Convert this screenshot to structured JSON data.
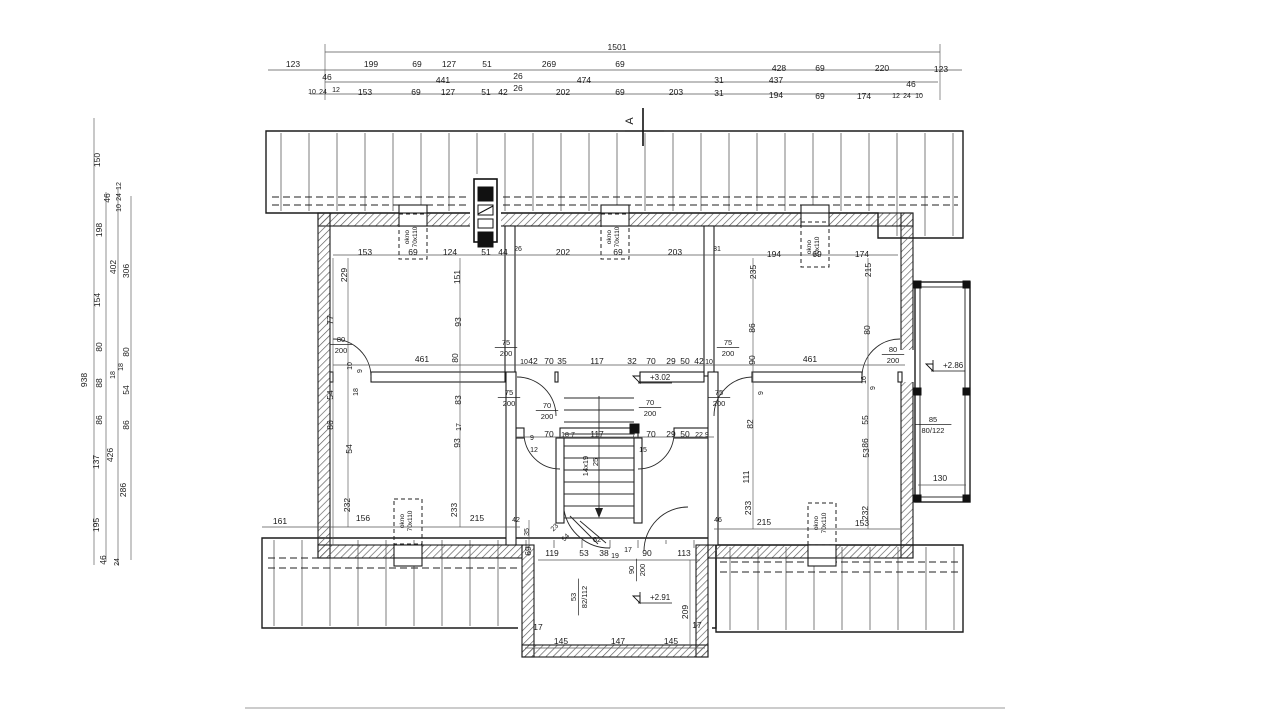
{
  "section_marker": {
    "label": "A"
  },
  "window_label": {
    "line1": "okno",
    "line2": "70x110"
  },
  "stair": {
    "steps": "14x19",
    "tread": "25"
  },
  "levels": [
    {
      "t": "+3.02",
      "x": 648,
      "y": 380
    },
    {
      "t": "+2.86",
      "x": 941,
      "y": 368
    },
    {
      "t": "+2.91",
      "x": 648,
      "y": 600
    }
  ],
  "fractions": [
    {
      "tp": "80",
      "bt": "200",
      "x": 341,
      "y": 344
    },
    {
      "tp": "75",
      "bt": "200",
      "x": 506,
      "y": 347
    },
    {
      "tp": "75",
      "bt": "200",
      "x": 728,
      "y": 347
    },
    {
      "tp": "80",
      "bt": "200",
      "x": 893,
      "y": 354
    },
    {
      "tp": "75",
      "bt": "200",
      "x": 509,
      "y": 397
    },
    {
      "tp": "70",
      "bt": "200",
      "x": 547,
      "y": 410
    },
    {
      "tp": "70",
      "bt": "200",
      "x": 650,
      "y": 407
    },
    {
      "tp": "75",
      "bt": "200",
      "x": 719,
      "y": 397
    },
    {
      "tp": "90",
      "bt": "200",
      "x": 636,
      "y": 570,
      "r": -90
    },
    {
      "tp": "85",
      "bt": "80/122",
      "x": 933,
      "y": 424
    },
    {
      "tp": "53",
      "bt": "82/112",
      "x": 578,
      "y": 597,
      "r": -90
    }
  ],
  "windows": [
    {
      "x": 411,
      "y": 237,
      "rect": [
        399,
        214,
        28,
        45
      ]
    },
    {
      "x": 613,
      "y": 237,
      "rect": [
        601,
        214,
        28,
        45
      ]
    },
    {
      "x": 813,
      "y": 247,
      "rect": [
        801,
        222,
        28,
        45
      ]
    },
    {
      "x": 406,
      "y": 521,
      "rect": [
        394,
        499,
        28,
        45
      ]
    },
    {
      "x": 820,
      "y": 523,
      "rect": [
        808,
        503,
        28,
        42
      ]
    }
  ],
  "labels": [
    {
      "t": "1501",
      "x": 617,
      "y": 50
    },
    {
      "t": "123",
      "x": 293,
      "y": 67
    },
    {
      "t": "199",
      "x": 371,
      "y": 67
    },
    {
      "t": "69",
      "x": 417,
      "y": 67
    },
    {
      "t": "127",
      "x": 449,
      "y": 67
    },
    {
      "t": "51",
      "x": 487,
      "y": 67
    },
    {
      "t": "269",
      "x": 549,
      "y": 67
    },
    {
      "t": "69",
      "x": 620,
      "y": 67
    },
    {
      "t": "428",
      "x": 779,
      "y": 71
    },
    {
      "t": "69",
      "x": 820,
      "y": 71
    },
    {
      "t": "220",
      "x": 882,
      "y": 71
    },
    {
      "t": "123",
      "x": 941,
      "y": 72
    },
    {
      "t": "46",
      "x": 327,
      "y": 80
    },
    {
      "t": "441",
      "x": 443,
      "y": 83
    },
    {
      "t": "26",
      "x": 518,
      "y": 79
    },
    {
      "t": "474",
      "x": 584,
      "y": 83
    },
    {
      "t": "31",
      "x": 719,
      "y": 83
    },
    {
      "t": "437",
      "x": 776,
      "y": 83
    },
    {
      "t": "46",
      "x": 911,
      "y": 87
    },
    {
      "t": "10",
      "x": 312,
      "y": 94,
      "f": 7
    },
    {
      "t": "24",
      "x": 323,
      "y": 94,
      "f": 7
    },
    {
      "t": "12",
      "x": 336,
      "y": 92,
      "f": 7
    },
    {
      "t": "153",
      "x": 365,
      "y": 95
    },
    {
      "t": "69",
      "x": 416,
      "y": 95
    },
    {
      "t": "127",
      "x": 448,
      "y": 95
    },
    {
      "t": "51",
      "x": 486,
      "y": 95
    },
    {
      "t": "42",
      "x": 503,
      "y": 95
    },
    {
      "t": "26",
      "x": 518,
      "y": 91
    },
    {
      "t": "202",
      "x": 563,
      "y": 95
    },
    {
      "t": "69",
      "x": 620,
      "y": 95
    },
    {
      "t": "203",
      "x": 676,
      "y": 95
    },
    {
      "t": "31",
      "x": 719,
      "y": 96
    },
    {
      "t": "194",
      "x": 776,
      "y": 98
    },
    {
      "t": "69",
      "x": 820,
      "y": 99
    },
    {
      "t": "174",
      "x": 864,
      "y": 99
    },
    {
      "t": "12",
      "x": 896,
      "y": 98,
      "f": 7
    },
    {
      "t": "24",
      "x": 907,
      "y": 98,
      "f": 7
    },
    {
      "t": "10",
      "x": 919,
      "y": 98,
      "f": 7
    },
    {
      "t": "150",
      "x": 100,
      "y": 160,
      "r": -90
    },
    {
      "t": "46",
      "x": 110,
      "y": 198,
      "r": -90
    },
    {
      "t": "12",
      "x": 121,
      "y": 186,
      "r": -90,
      "f": 7
    },
    {
      "t": "24",
      "x": 121,
      "y": 197,
      "r": -90,
      "f": 7
    },
    {
      "t": "10",
      "x": 121,
      "y": 208,
      "r": -90,
      "f": 7
    },
    {
      "t": "198",
      "x": 102,
      "y": 230,
      "r": -90
    },
    {
      "t": "402",
      "x": 116,
      "y": 267,
      "r": -90
    },
    {
      "t": "306",
      "x": 129,
      "y": 271,
      "r": -90
    },
    {
      "t": "154",
      "x": 100,
      "y": 300,
      "r": -90
    },
    {
      "t": "938",
      "x": 87,
      "y": 380,
      "r": -90
    },
    {
      "t": "80",
      "x": 102,
      "y": 347,
      "r": -90
    },
    {
      "t": "80",
      "x": 129,
      "y": 352,
      "r": -90
    },
    {
      "t": "88",
      "x": 102,
      "y": 383,
      "r": -90
    },
    {
      "t": "18",
      "x": 115,
      "y": 375,
      "r": -90,
      "f": 7
    },
    {
      "t": "18",
      "x": 123,
      "y": 367,
      "r": -90,
      "f": 7
    },
    {
      "t": "54",
      "x": 129,
      "y": 390,
      "r": -90
    },
    {
      "t": "86",
      "x": 102,
      "y": 420,
      "r": -90
    },
    {
      "t": "86",
      "x": 129,
      "y": 425,
      "r": -90
    },
    {
      "t": "137",
      "x": 99,
      "y": 462,
      "r": -90
    },
    {
      "t": "426",
      "x": 113,
      "y": 455,
      "r": -90
    },
    {
      "t": "286",
      "x": 126,
      "y": 490,
      "r": -90
    },
    {
      "t": "195",
      "x": 99,
      "y": 525,
      "r": -90
    },
    {
      "t": "46",
      "x": 106,
      "y": 560,
      "r": -90
    },
    {
      "t": "24",
      "x": 119,
      "y": 562,
      "r": -90,
      "f": 7
    },
    {
      "t": "153",
      "x": 365,
      "y": 255
    },
    {
      "t": "69",
      "x": 413,
      "y": 255
    },
    {
      "t": "124",
      "x": 450,
      "y": 255
    },
    {
      "t": "51",
      "x": 486,
      "y": 255
    },
    {
      "t": "44",
      "x": 503,
      "y": 255
    },
    {
      "t": "26",
      "x": 518,
      "y": 251,
      "f": 7
    },
    {
      "t": "202",
      "x": 563,
      "y": 255
    },
    {
      "t": "69",
      "x": 618,
      "y": 255
    },
    {
      "t": "203",
      "x": 675,
      "y": 255
    },
    {
      "t": "31",
      "x": 717,
      "y": 251,
      "f": 7
    },
    {
      "t": "194",
      "x": 774,
      "y": 257
    },
    {
      "t": "69",
      "x": 817,
      "y": 257
    },
    {
      "t": "174",
      "x": 862,
      "y": 257
    },
    {
      "t": "229",
      "x": 347,
      "y": 275,
      "r": -90
    },
    {
      "t": "151",
      "x": 460,
      "y": 277,
      "r": -90
    },
    {
      "t": "235",
      "x": 756,
      "y": 272,
      "r": -90
    },
    {
      "t": "215",
      "x": 871,
      "y": 270,
      "r": -90
    },
    {
      "t": "77",
      "x": 333,
      "y": 320,
      "r": -90
    },
    {
      "t": "93",
      "x": 461,
      "y": 322,
      "r": -90
    },
    {
      "t": "86",
      "x": 755,
      "y": 328,
      "r": -90
    },
    {
      "t": "80",
      "x": 870,
      "y": 330,
      "r": -90
    },
    {
      "t": "90",
      "x": 755,
      "y": 360,
      "r": -90
    },
    {
      "t": "80",
      "x": 458,
      "y": 358,
      "r": -90
    },
    {
      "t": "461",
      "x": 422,
      "y": 362
    },
    {
      "t": "10",
      "x": 524,
      "y": 364,
      "f": 7
    },
    {
      "t": "42",
      "x": 533,
      "y": 364
    },
    {
      "t": "70",
      "x": 549,
      "y": 364
    },
    {
      "t": "35",
      "x": 562,
      "y": 364
    },
    {
      "t": "117",
      "x": 597,
      "y": 364
    },
    {
      "t": "32",
      "x": 632,
      "y": 364
    },
    {
      "t": "70",
      "x": 651,
      "y": 364
    },
    {
      "t": "29",
      "x": 671,
      "y": 364
    },
    {
      "t": "50",
      "x": 685,
      "y": 364
    },
    {
      "t": "42",
      "x": 699,
      "y": 364
    },
    {
      "t": "10",
      "x": 709,
      "y": 364,
      "f": 7
    },
    {
      "t": "461",
      "x": 810,
      "y": 362
    },
    {
      "t": "10",
      "x": 352,
      "y": 366,
      "r": -90,
      "f": 7
    },
    {
      "t": "9",
      "x": 362,
      "y": 371,
      "r": -90,
      "f": 7
    },
    {
      "t": "16",
      "x": 866,
      "y": 380,
      "r": -90,
      "f": 7
    },
    {
      "t": "9",
      "x": 875,
      "y": 388,
      "r": -90,
      "f": 7
    },
    {
      "t": "9",
      "x": 763,
      "y": 393,
      "r": -90,
      "f": 7
    },
    {
      "t": "9",
      "x": 532,
      "y": 440,
      "f": 7
    },
    {
      "t": "70",
      "x": 549,
      "y": 437
    },
    {
      "t": "18",
      "x": 565,
      "y": 437,
      "f": 7
    },
    {
      "t": "7",
      "x": 573,
      "y": 437,
      "f": 7
    },
    {
      "t": "117",
      "x": 597,
      "y": 437
    },
    {
      "t": "7",
      "x": 634,
      "y": 437,
      "f": 7
    },
    {
      "t": "70",
      "x": 651,
      "y": 437
    },
    {
      "t": "29",
      "x": 671,
      "y": 437
    },
    {
      "t": "50",
      "x": 685,
      "y": 437
    },
    {
      "t": "22",
      "x": 699,
      "y": 437,
      "f": 7
    },
    {
      "t": "9",
      "x": 707,
      "y": 437,
      "f": 7
    },
    {
      "t": "12",
      "x": 534,
      "y": 452,
      "f": 7
    },
    {
      "t": "15",
      "x": 643,
      "y": 452,
      "f": 7
    },
    {
      "t": "14x19",
      "x": 588,
      "y": 466,
      "r": -90,
      "f": 7.5
    },
    {
      "t": "25",
      "x": 598,
      "y": 462,
      "r": -90,
      "f": 7.5
    },
    {
      "t": "54",
      "x": 333,
      "y": 395,
      "r": -90
    },
    {
      "t": "18",
      "x": 358,
      "y": 392,
      "r": -90,
      "f": 7
    },
    {
      "t": "86",
      "x": 333,
      "y": 425,
      "r": -90
    },
    {
      "t": "83",
      "x": 461,
      "y": 400,
      "r": -90
    },
    {
      "t": "17",
      "x": 461,
      "y": 427,
      "r": -90,
      "f": 7
    },
    {
      "t": "54",
      "x": 352,
      "y": 449,
      "r": -90
    },
    {
      "t": "93",
      "x": 460,
      "y": 443,
      "r": -90
    },
    {
      "t": "232",
      "x": 350,
      "y": 505,
      "r": -90
    },
    {
      "t": "233",
      "x": 457,
      "y": 510,
      "r": -90
    },
    {
      "t": "161",
      "x": 280,
      "y": 524
    },
    {
      "t": "156",
      "x": 363,
      "y": 521
    },
    {
      "t": "215",
      "x": 477,
      "y": 521
    },
    {
      "t": "42",
      "x": 516,
      "y": 522,
      "f": 7
    },
    {
      "t": "82",
      "x": 753,
      "y": 424,
      "r": -90
    },
    {
      "t": "55",
      "x": 868,
      "y": 420,
      "r": -90
    },
    {
      "t": "86",
      "x": 868,
      "y": 443,
      "r": -90
    },
    {
      "t": "111",
      "x": 749,
      "y": 477,
      "r": -90
    },
    {
      "t": "53",
      "x": 869,
      "y": 453,
      "r": -90
    },
    {
      "t": "233",
      "x": 751,
      "y": 508,
      "r": -90
    },
    {
      "t": "232",
      "x": 868,
      "y": 513,
      "r": -90
    },
    {
      "t": "215",
      "x": 764,
      "y": 525
    },
    {
      "t": "153",
      "x": 862,
      "y": 526
    },
    {
      "t": "46",
      "x": 718,
      "y": 522,
      "f": 7
    },
    {
      "t": "130",
      "x": 940,
      "y": 481
    },
    {
      "t": "209",
      "x": 688,
      "y": 612,
      "r": -90
    },
    {
      "t": "35",
      "x": 529,
      "y": 532,
      "r": -90,
      "f": 7
    },
    {
      "t": "69",
      "x": 531,
      "y": 551,
      "r": -90
    },
    {
      "t": "23",
      "x": 556,
      "y": 529,
      "r": -45,
      "f": 7
    },
    {
      "t": "54",
      "x": 567,
      "y": 539,
      "r": -45,
      "f": 7
    },
    {
      "t": "62",
      "x": 597,
      "y": 542,
      "f": 7.5
    },
    {
      "t": "119",
      "x": 552,
      "y": 556
    },
    {
      "t": "53",
      "x": 584,
      "y": 556
    },
    {
      "t": "38",
      "x": 604,
      "y": 556
    },
    {
      "t": "19",
      "x": 615,
      "y": 558,
      "f": 7
    },
    {
      "t": "17",
      "x": 628,
      "y": 552,
      "f": 7
    },
    {
      "t": "90",
      "x": 647,
      "y": 556
    },
    {
      "t": "113",
      "x": 684,
      "y": 556
    },
    {
      "t": "17",
      "x": 538,
      "y": 630
    },
    {
      "t": "145",
      "x": 561,
      "y": 644
    },
    {
      "t": "147",
      "x": 618,
      "y": 644
    },
    {
      "t": "145",
      "x": 671,
      "y": 644
    },
    {
      "t": "17",
      "x": 697,
      "y": 628
    }
  ]
}
